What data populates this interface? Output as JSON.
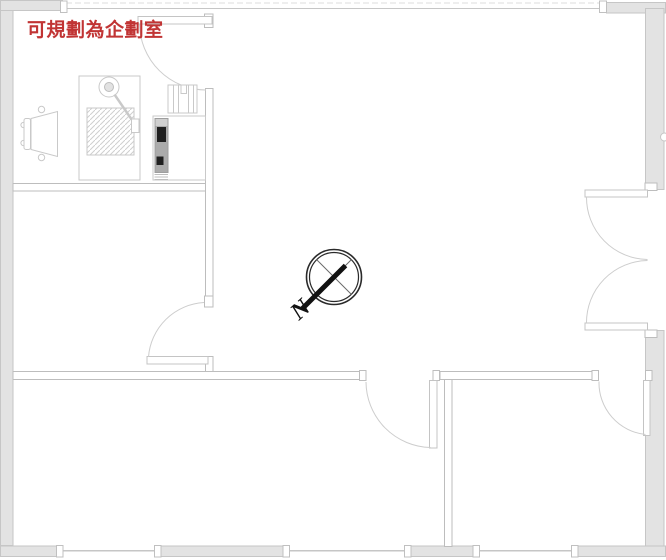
{
  "floor_plan": {
    "annotation": {
      "text": "可規劃為企劃室",
      "color": "#c13434"
    },
    "compass": {
      "north_label": "N"
    },
    "colors": {
      "wall_fill": "#e3e3e3",
      "wall_stroke": "#c6c6c6",
      "partition_stroke": "#bdbdbd",
      "door_line": "#c9c9c9",
      "annotation_red": "#c13434",
      "compass_black": "#1a1a1a"
    }
  }
}
